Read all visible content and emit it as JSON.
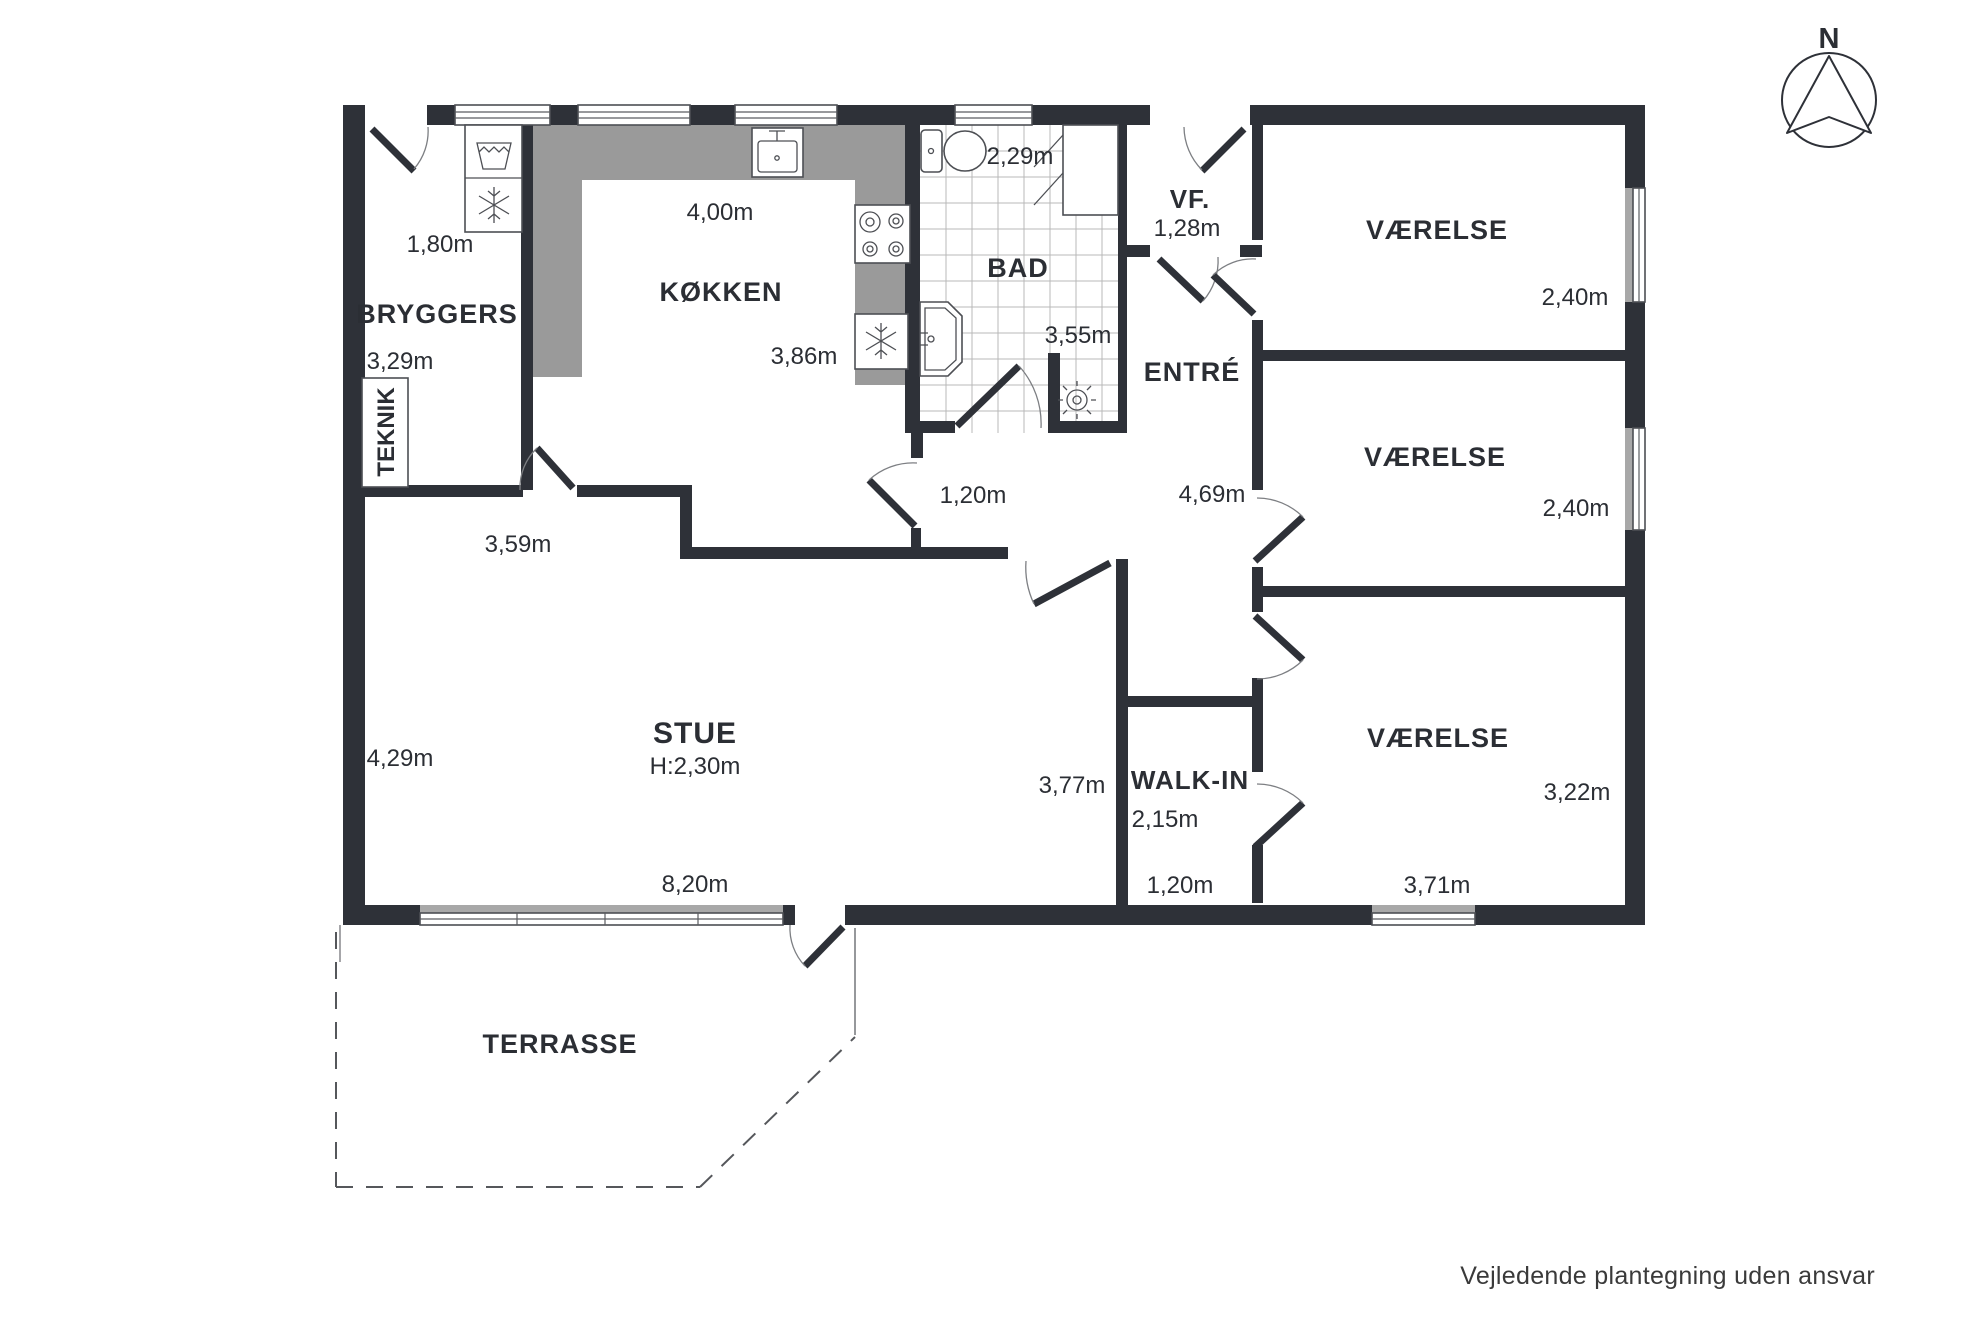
{
  "disclaimer": "Vejledende plantegning uden ansvar",
  "compass": {
    "north_label": "N"
  },
  "colors": {
    "wall": "#2e3138",
    "counter": "#9a9a9a",
    "window_band": "#a8a8a8",
    "text": "#2b2e34"
  },
  "rooms": {
    "bryggers": {
      "label": "BRYGGERS",
      "width": "1,80m",
      "depth": "3,29m"
    },
    "teknik": {
      "label": "TEKNIK"
    },
    "kokken": {
      "label": "KØKKEN",
      "width": "4,00m",
      "depth": "3,86m"
    },
    "bad": {
      "label": "BAD",
      "width": "2,29m",
      "depth": "3,55m"
    },
    "vf": {
      "label": "VF.",
      "width": "1,28m"
    },
    "entre": {
      "label": "ENTRÉ",
      "depth": "4,69m"
    },
    "vaerelse1": {
      "label": "VÆRELSE",
      "width": "2,40m"
    },
    "vaerelse2": {
      "label": "VÆRELSE",
      "width": "2,40m"
    },
    "vaerelse3": {
      "label": "VÆRELSE",
      "depth": "3,22m",
      "width": "3,71m"
    },
    "stue": {
      "label": "STUE",
      "ceiling_height": "H:2,30m",
      "top_width": "3,59m",
      "left_depth": "4,29m",
      "bottom_width": "8,20m",
      "opening": "1,20m",
      "right_depth": "3,77m"
    },
    "walkin": {
      "label": "WALK-IN",
      "depth": "2,15m",
      "width": "1,20m"
    },
    "terrasse": {
      "label": "TERRASSE"
    }
  }
}
